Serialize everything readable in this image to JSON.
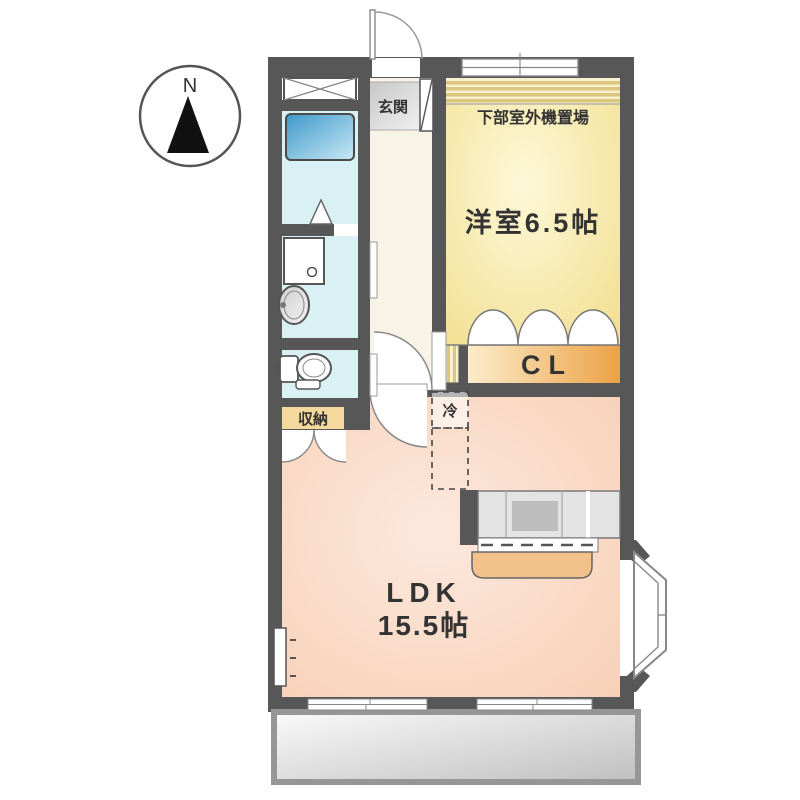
{
  "title": "apartment-floorplan",
  "compass": {
    "north_label": "N"
  },
  "labels": {
    "entrance": "玄関",
    "outdoor_unit": "下部室外機置場",
    "western_room": "洋室6.5帖",
    "closet": "CL",
    "storage": "収納",
    "refrigerator": "冷",
    "ldk_line1": "LDK",
    "ldk_line2": "15.5帖"
  },
  "colors": {
    "wall": "#575757",
    "western_center": "#fdf8d8",
    "western_edge": "#f3e093",
    "ldk_center": "#fce9dd",
    "ldk_edge": "#f8cfb6",
    "hallway": "#f9f2e6",
    "bath": "#d9f0f4",
    "tub_dark": "#3e98c9",
    "tub_light": "#c9e8f6",
    "closet_light": "#fbeccb",
    "closet_dark": "#eca145",
    "storage": "#f4d89c",
    "genkan_dark": "#c6c6c6",
    "genkan_light": "#f0f0f0",
    "balcony_light": "#fafafa",
    "balcony_dark": "#bfbfbf",
    "counter": "#e3e3e3",
    "sink": "#bdbdbd",
    "bar_counter": "#f2c189",
    "stripe_gold": "#dcc57e",
    "stripe_bg": "#f8f1cd",
    "text": "#333333"
  }
}
